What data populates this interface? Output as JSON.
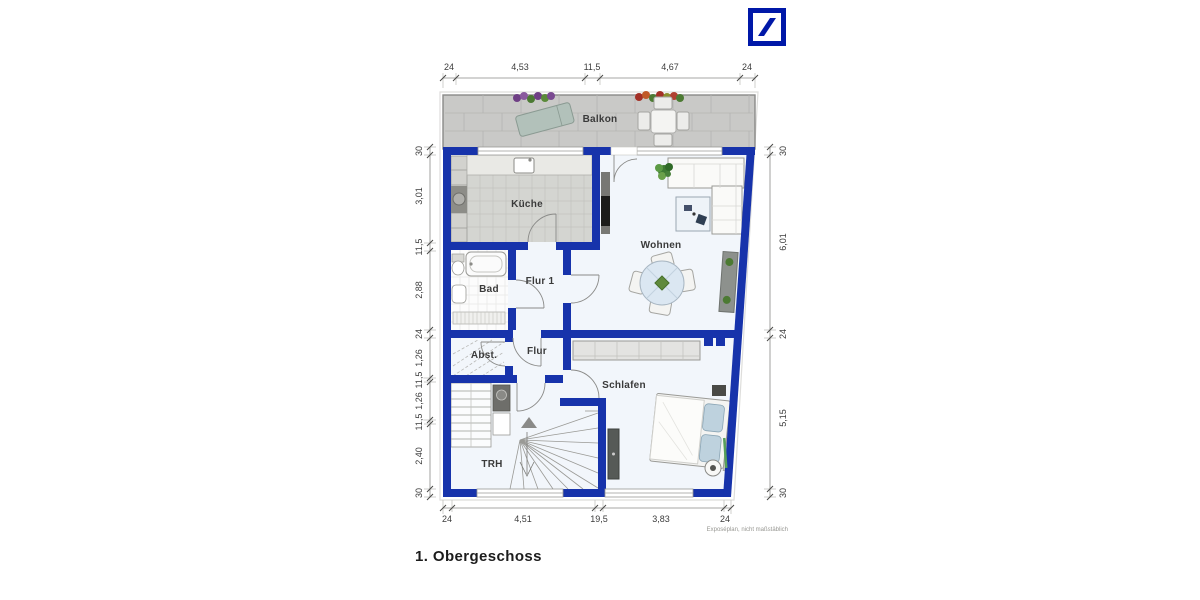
{
  "page": {
    "title": "1. Obergeschoss",
    "footnote": "Exposéplan, nicht maßstäblich"
  },
  "logo": {
    "brand": "deutsche-bank",
    "color": "#0018A8"
  },
  "rooms": {
    "balkon": "Balkon",
    "kueche": "Küche",
    "wohnen": "Wohnen",
    "bad": "Bad",
    "flur1": "Flur 1",
    "abst": "Abst.",
    "flur": "Flur",
    "schlafen": "Schlafen",
    "trh": "TRH"
  },
  "dims": {
    "top": [
      "24",
      "4,53",
      "11,5",
      "4,67",
      "24"
    ],
    "bottom": [
      "24",
      "4,51",
      "19,5",
      "3,83",
      "24"
    ],
    "left": [
      "30",
      "3,01",
      "11,5",
      "2,88",
      "24",
      "1,26",
      "11,5",
      "1,26",
      "11,5",
      "2,40",
      "30"
    ],
    "right": [
      "30",
      "6,01",
      "24",
      "5,15",
      "30"
    ]
  },
  "colors": {
    "wall_blue": "#1733ab",
    "logo_blue": "#0018A8",
    "floor": "#f2f6fb",
    "kitchen_tile": "#d4d5d1",
    "balcony_gray": "#c9c9c7"
  }
}
